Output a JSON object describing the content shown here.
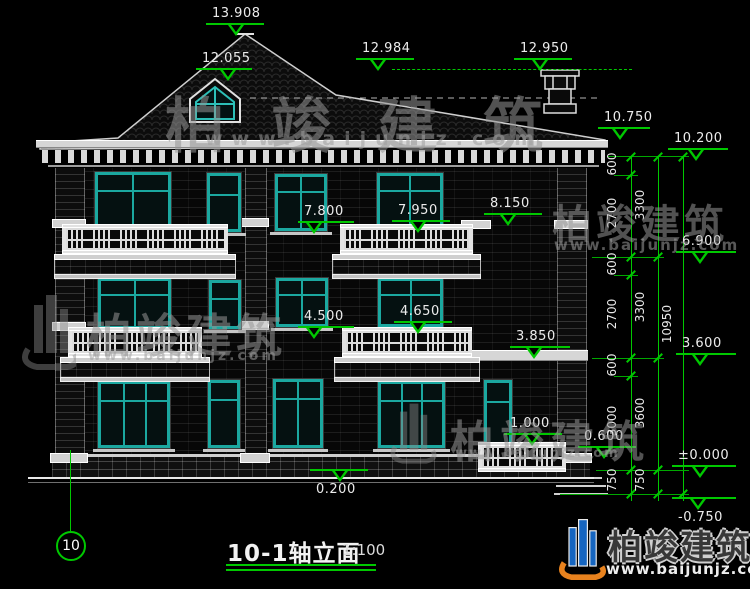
{
  "title": {
    "text": "10-1轴立面",
    "scale": "1:100"
  },
  "axis": {
    "label": "10"
  },
  "watermark": {
    "brand": "柏竣建筑",
    "url": "www.baijunjz.com"
  },
  "elevations": {
    "ridge": "13.908",
    "dormer": "12.055",
    "upper_roof": "12.984",
    "chimney": "12.950",
    "eave": "10.750",
    "parapet": "10.200",
    "bay_coping": "8.150",
    "f3_rail_center": "7.950",
    "f3_rail_left": "7.800",
    "f3_floor": "6.900",
    "f2_rail_center": "4.650",
    "f2_rail_left": "4.500",
    "porch_roof": "3.850",
    "f2_floor": "3.600",
    "porch_rail": "1.000",
    "porch_floor": "0.600",
    "ground_step": "0.200",
    "ground": "±0.000",
    "foundation": "-0.750"
  },
  "dimensions": {
    "seg600": "600",
    "seg2700": "2700",
    "seg3000": "3000",
    "seg750": "750",
    "floor3300": "3300",
    "floor3600": "3600",
    "total": "10950"
  },
  "colors": {
    "dim_green": "#00c800",
    "frame_teal": "#1ba8a0",
    "line_white": "#e4e4e4",
    "logo_blue": "#1565c0",
    "logo_orange": "#e8821e"
  }
}
